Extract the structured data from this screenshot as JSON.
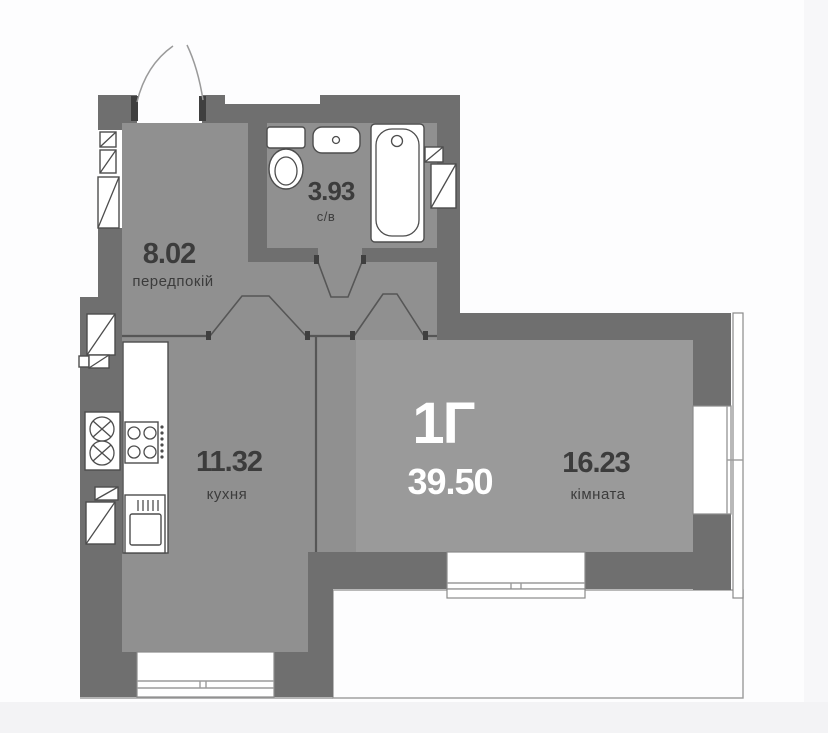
{
  "plan": {
    "unit_label": "1Г",
    "total_area": "39.50",
    "rooms": {
      "hallway": {
        "area": "8.02",
        "name": "передпокій"
      },
      "bathroom": {
        "area": "3.93",
        "name": "с/в"
      },
      "kitchen": {
        "area": "11.32",
        "name": "кухня"
      },
      "living_room": {
        "area": "16.23",
        "name": "кімната"
      }
    }
  },
  "colors": {
    "wall": "#6F6F6F",
    "floor": "#909090",
    "room_floor": "#9A9A9A",
    "text_dark": "#3C3C3C",
    "text_light": "#FFFFFF",
    "background": "#FDFDFE"
  }
}
